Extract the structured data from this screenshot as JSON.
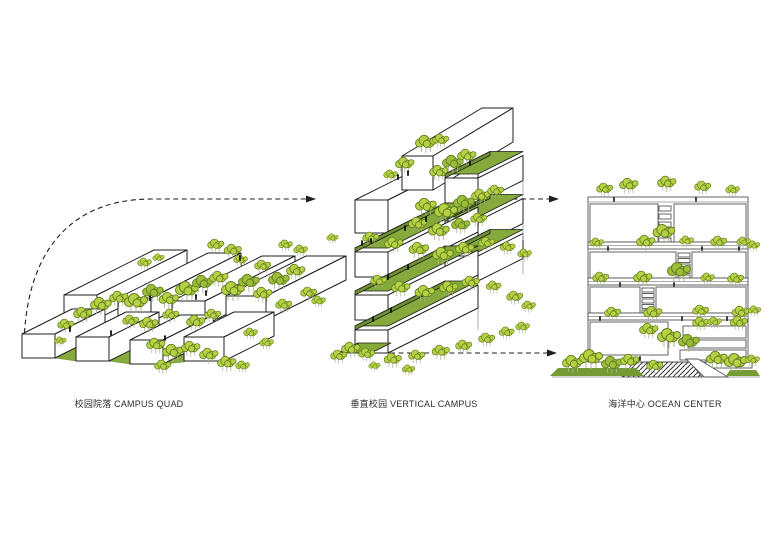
{
  "diagram": {
    "steps": [
      {
        "id": "campus-quad",
        "label": "校园院落 CAMPUS QUAD"
      },
      {
        "id": "vertical-campus",
        "label": "垂直校园 VERTICAL CAMPUS"
      },
      {
        "id": "ocean-center",
        "label": "海洋中心 OCEAN CENTER"
      }
    ]
  },
  "colors": {
    "background": "#ffffff",
    "line": "#1f1f1f",
    "facade-line": "#555555",
    "tree-fill": "#b6d144",
    "tree-dark": "#9cbd3a",
    "tree-stroke": "#627f1d",
    "green-top": "#85aa3b",
    "green-side": "#6d9130",
    "ground-green": "#749a33",
    "trunk": "#a8b08a"
  }
}
